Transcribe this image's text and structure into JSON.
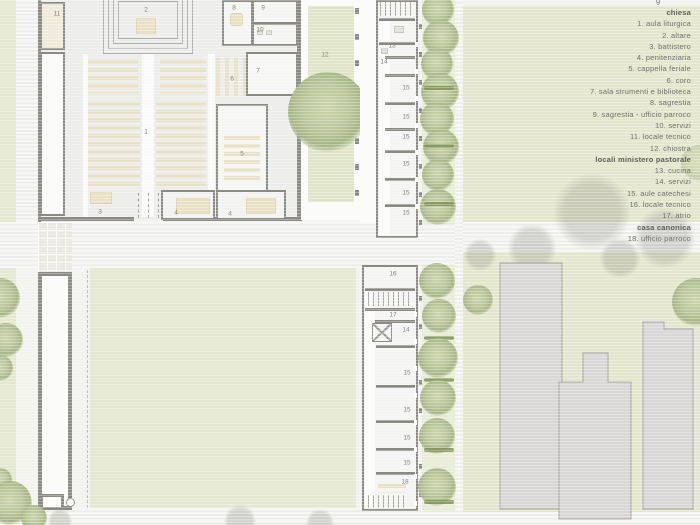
{
  "legend": {
    "clipped_fragment": "g",
    "lines": [
      {
        "text": "chiesa",
        "header": true
      },
      {
        "text": "1. aula liturgica"
      },
      {
        "text": "2. altare"
      },
      {
        "text": "3. battistero"
      },
      {
        "text": "4. penitenziaria"
      },
      {
        "text": "5. cappella feriale"
      },
      {
        "text": "6. coro"
      },
      {
        "text": "7. sala strumenti e biblioteca"
      },
      {
        "text": "8. sagrestia"
      },
      {
        "text": "9. sagrestia - ufficio parroco"
      },
      {
        "text": "10. servizi"
      },
      {
        "text": "11. locale tecnico"
      },
      {
        "text": "12. chiostra"
      },
      {
        "text": "locali ministero pastorale",
        "header": true
      },
      {
        "text": "13. cucina"
      },
      {
        "text": "14. servizi"
      },
      {
        "text": "15. aule catechesi"
      },
      {
        "text": "16. locale tecnico"
      },
      {
        "text": "17. atrio"
      },
      {
        "text": "casa canonica",
        "header": true
      },
      {
        "text": "18. ufficio parroco"
      }
    ]
  },
  "plan": {
    "labels": [
      {
        "t": "11",
        "x": 57,
        "y": 14
      },
      {
        "t": "2",
        "x": 146,
        "y": 10
      },
      {
        "t": "8",
        "x": 234,
        "y": 8
      },
      {
        "t": "9",
        "x": 263,
        "y": 8
      },
      {
        "t": "10",
        "x": 260,
        "y": 30
      },
      {
        "t": "7",
        "x": 258,
        "y": 71
      },
      {
        "t": "6",
        "x": 232,
        "y": 79
      },
      {
        "t": "1",
        "x": 146,
        "y": 132
      },
      {
        "t": "5",
        "x": 242,
        "y": 154
      },
      {
        "t": "3",
        "x": 100,
        "y": 212
      },
      {
        "t": "4",
        "x": 176,
        "y": 213
      },
      {
        "t": "4",
        "x": 230,
        "y": 214
      },
      {
        "t": "12",
        "x": 325,
        "y": 55
      },
      {
        "t": "13",
        "x": 392,
        "y": 46
      },
      {
        "t": "14",
        "x": 384,
        "y": 62
      },
      {
        "t": "15",
        "x": 406,
        "y": 88
      },
      {
        "t": "15",
        "x": 406,
        "y": 117
      },
      {
        "t": "15",
        "x": 406,
        "y": 137
      },
      {
        "t": "15",
        "x": 406,
        "y": 164
      },
      {
        "t": "15",
        "x": 406,
        "y": 193
      },
      {
        "t": "15",
        "x": 406,
        "y": 213
      },
      {
        "t": "16",
        "x": 393,
        "y": 274
      },
      {
        "t": "17",
        "x": 393,
        "y": 315
      },
      {
        "t": "14",
        "x": 406,
        "y": 330
      },
      {
        "t": "15",
        "x": 407,
        "y": 373
      },
      {
        "t": "15",
        "x": 407,
        "y": 410
      },
      {
        "t": "15",
        "x": 407,
        "y": 438
      },
      {
        "t": "15",
        "x": 407,
        "y": 463
      },
      {
        "t": "18",
        "x": 405,
        "y": 482
      }
    ]
  },
  "colors": {
    "wall": "#8b8984",
    "lawn": "#e4e8d1",
    "legend_panel": "#e3e6cc",
    "tree": "#b7c396",
    "hedge": "#7f9355",
    "existing_building": "#d9d6d6",
    "furniture": "#e9e1c4",
    "floor": "#ececea",
    "legend_text": "#70706c"
  }
}
